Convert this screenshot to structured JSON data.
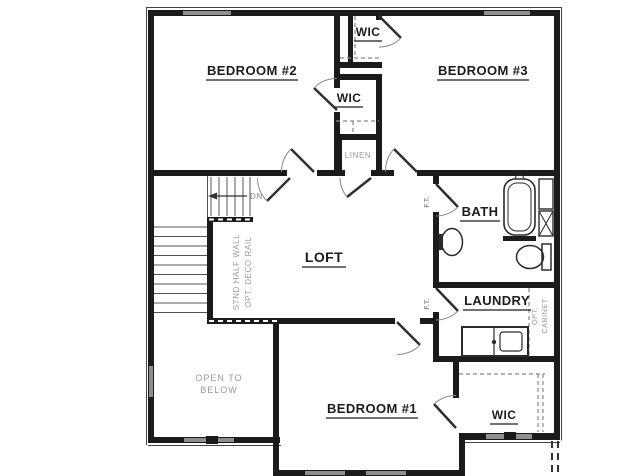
{
  "plan": {
    "rooms": {
      "bedroom2": "BEDROOM #2",
      "bedroom3": "BEDROOM #3",
      "bedroom1": "BEDROOM #1",
      "loft": "LOFT",
      "bath": "BATH",
      "laundry": "LAUNDRY",
      "wic_top": "WIC",
      "wic_middle": "WIC",
      "wic_bottom": "WIC",
      "linen": "LINEN"
    },
    "annotations": {
      "open_to_below_line1": "OPEN TO",
      "open_to_below_line2": "BELOW",
      "stair_direction": "DN",
      "half_wall_line1": "STND HALF WALL",
      "half_wall_line2": "OPT. DECO RAIL",
      "opt_cabinet_line1": "OPT.",
      "opt_cabinet_line2": "CABINET",
      "floor_transition_bath": "F.T.",
      "floor_transition_laundry": "F.T."
    },
    "colors": {
      "wall": "#1b1b1b",
      "window": "#8f8f8f",
      "background": "#ffffff",
      "muted_label": "#9a9a9a"
    }
  }
}
